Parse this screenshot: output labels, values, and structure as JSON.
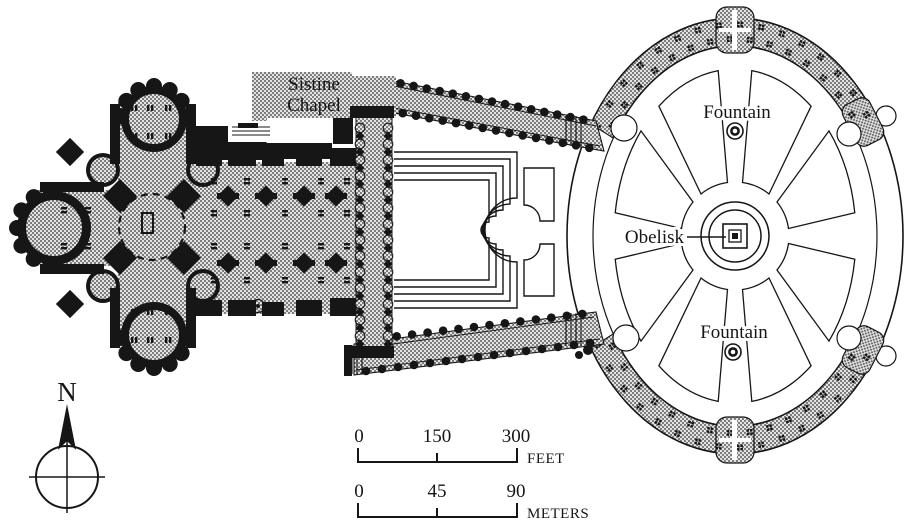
{
  "labels": {
    "sistine_line1": "Sistine",
    "sistine_line2": "Chapel",
    "fountain_north": "Fountain",
    "fountain_south": "Fountain",
    "obelisk": "Obelisk",
    "north": "N"
  },
  "scale_feet": {
    "t0": "0",
    "t1": "150",
    "t2": "300",
    "unit": "FEET"
  },
  "scale_meters": {
    "t0": "0",
    "t1": "45",
    "t2": "90",
    "unit": "METERS"
  },
  "colors": {
    "ink": "#161616",
    "paper": "#ffffff",
    "halftone_bg": "#e3e3e3",
    "halftone_dot": "#555555"
  },
  "icons": {
    "north_arrow": "compass-rose-with-solid-arrowhead",
    "fountain_symbol": "double-circle",
    "obelisk_marker": "nested-squares-with-solid-center",
    "column_marker": "solid-dot",
    "colonnade_marker": "four-dot-cluster"
  }
}
